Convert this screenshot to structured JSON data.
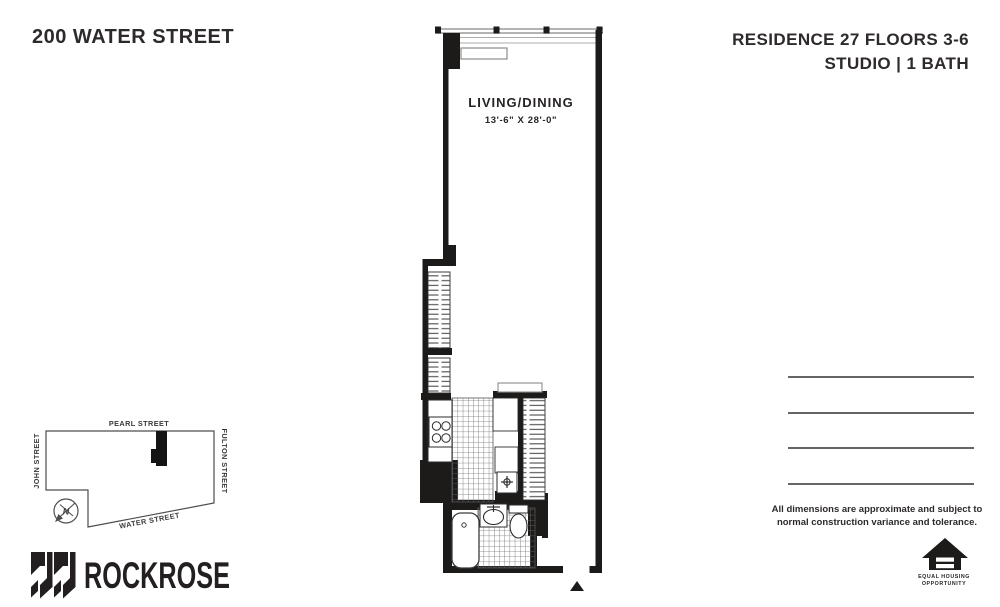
{
  "header": {
    "building": "200 WATER STREET",
    "residence_line": "RESIDENCE 27 FLOORS 3-6",
    "unit_line": "STUDIO | 1 BATH"
  },
  "floorplan": {
    "room_label": "LIVING/DINING",
    "room_dimensions": "13'-6\" X 28'-0\""
  },
  "site_map": {
    "streets": {
      "top": "PEARL STREET",
      "left": "JOHN STREET",
      "right": "FULTON STREET",
      "bottom": "WATER STREET"
    },
    "compass_label": "N"
  },
  "footer": {
    "brand": "ROCKROSE",
    "disclaimer_line1": "All dimensions are approximate and subject to",
    "disclaimer_line2": "normal construction variance and tolerance.",
    "equal_housing": {
      "line1": "EQUAL HOUSING",
      "line2": "OPPORTUNITY"
    }
  },
  "colors": {
    "wall": "#1d1a1a",
    "ink": "#2e2a2b",
    "line_gray": "#656565"
  }
}
